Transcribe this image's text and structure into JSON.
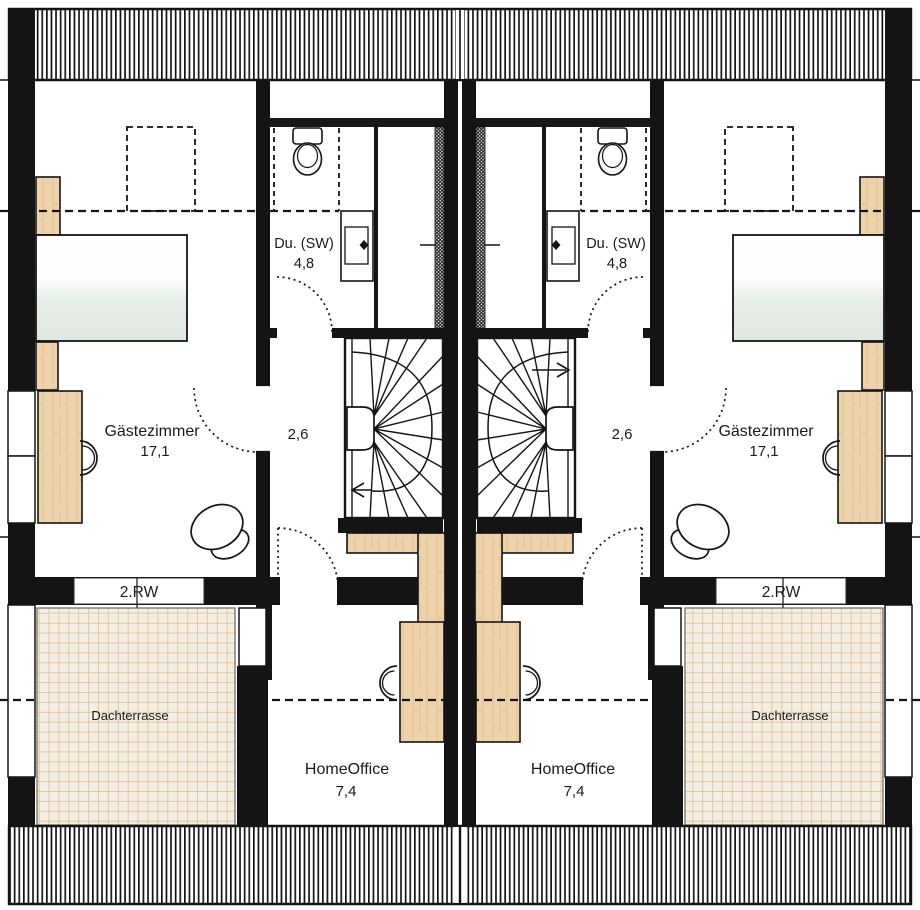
{
  "floorplan": {
    "rooms": {
      "guest": {
        "label": "Gästezimmer",
        "area": "17,1"
      },
      "shower": {
        "label": "Du. (SW)",
        "area": "4,8"
      },
      "stair_hall": {
        "area": "2,6"
      },
      "home_office": {
        "label": "HomeOffice",
        "area": "7,4"
      },
      "roof_terrace": {
        "label": "Dachterrasse"
      },
      "escape_window": {
        "label": "2.RW"
      }
    },
    "colors": {
      "wall": "#141414",
      "wood": "#eed2aa",
      "wood_grain": "#dcba8e",
      "bed_blanket": "#dfe7e1",
      "tile_bg": "#f2eee1",
      "tile_line": "#e3c5a4"
    }
  }
}
